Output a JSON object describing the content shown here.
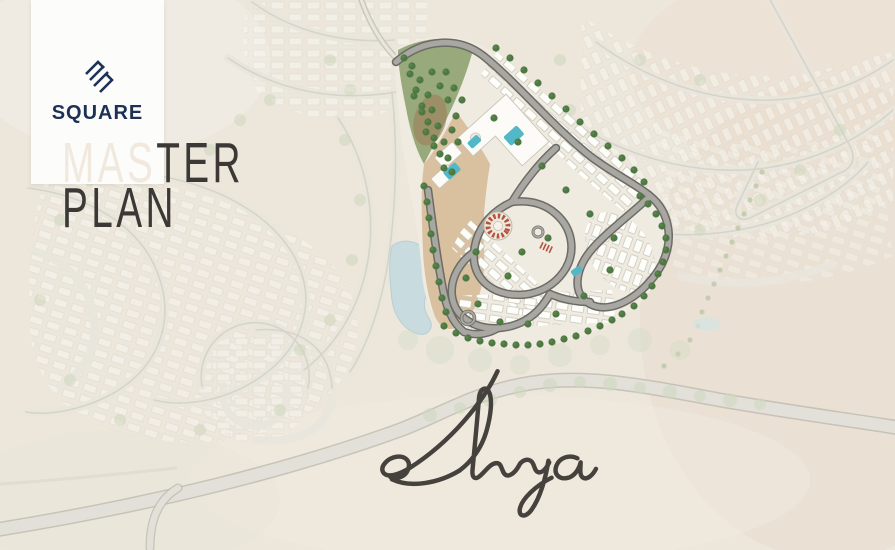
{
  "brand": {
    "name": "SQUARE",
    "color": "#1d3056"
  },
  "title": {
    "part_light": "MAS",
    "part_dark": "TER",
    "line2": "PLAN",
    "light_color": "#f1e9de",
    "dark_color": "#3b3835"
  },
  "project": {
    "name": "Rhya",
    "script_color": "#45423e"
  },
  "map": {
    "background": "#ece6db",
    "highway": "#e2e0d8",
    "faded_road": "#d5d2c7",
    "vegetation": "#ccd6ba",
    "lake": "#c7dce1",
    "site": {
      "sand": "#d9c09f",
      "hill": "#98a97b",
      "road": "#a8a7a1",
      "road_casing": "#6c6b66",
      "tree": "#4e7843",
      "building": "#fcfbf7",
      "pool": "#52b7c6",
      "amphitheater": "#b35340"
    }
  }
}
